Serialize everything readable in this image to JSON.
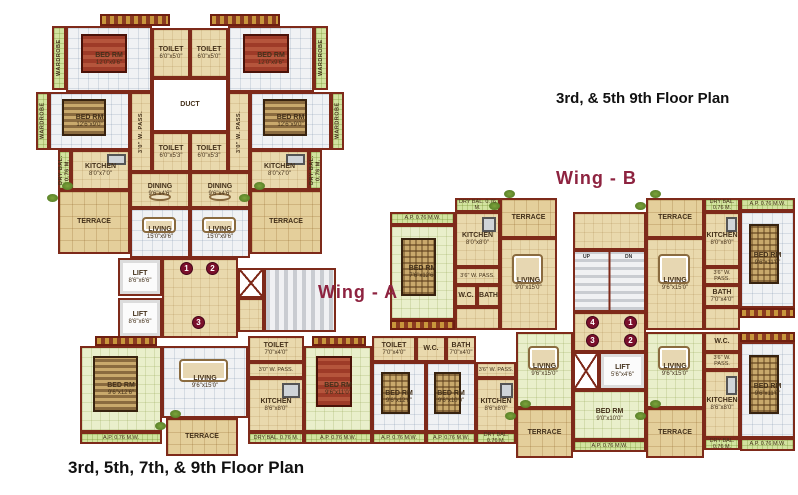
{
  "titles": {
    "plan_top": "3rd, & 5th 9th Floor Plan",
    "plan_bottom": "3rd, 5th, 7th, & 9th Floor Plan",
    "wing_a": "Wing - A",
    "wing_b": "Wing - B"
  },
  "colors": {
    "wall": "#7e2a1a",
    "floor_beige": "#e9d9ad",
    "floor_tile": "#f0f2f4",
    "floor_green": "#e9efcb",
    "terrace": "#e4cf9b",
    "balcony_strip": "#d2e39f",
    "stairs": "#c9ccd1",
    "marker": "#7a0f2b",
    "wing_label": "#8e2340",
    "title": "#111111"
  },
  "rooms": [
    {
      "id": "wardrobe-strip-1",
      "label": "WARDROBE",
      "x": 52,
      "y": 26,
      "w": 14,
      "h": 64,
      "fill": "strip",
      "dir": "v"
    },
    {
      "id": "bedroom-top-left",
      "label": "BED RM",
      "dims": "12'0\"x9'6\"",
      "x": 66,
      "y": 26,
      "w": 86,
      "h": 66,
      "fill": "white",
      "furn": "bed-red"
    },
    {
      "id": "toilet-top-1",
      "label": "TOILET",
      "dims": "6'0\"x5'0\"",
      "x": 152,
      "y": 28,
      "w": 38,
      "h": 50,
      "fill": "beige"
    },
    {
      "id": "toilet-top-2",
      "label": "TOILET",
      "dims": "6'0\"x5'0\"",
      "x": 190,
      "y": 28,
      "w": 38,
      "h": 50,
      "fill": "beige"
    },
    {
      "id": "bedroom-top-right",
      "label": "BED RM",
      "dims": "12'0\"x9'6\"",
      "x": 228,
      "y": 26,
      "w": 86,
      "h": 66,
      "fill": "white",
      "furn": "bed-red"
    },
    {
      "id": "wardrobe-strip-2",
      "label": "WARDROBE",
      "x": 314,
      "y": 26,
      "w": 14,
      "h": 64,
      "fill": "strip",
      "dir": "v"
    },
    {
      "id": "wardrobe-strip-3",
      "label": "WARDROBE",
      "x": 36,
      "y": 92,
      "w": 13,
      "h": 58,
      "fill": "strip",
      "dir": "v"
    },
    {
      "id": "bedroom-mid-left",
      "label": "BED RM",
      "dims": "12'6\"x9'0\"",
      "x": 49,
      "y": 92,
      "w": 81,
      "h": 58,
      "fill": "white",
      "furn": "bed-striped"
    },
    {
      "id": "duct",
      "label": "DUCT",
      "x": 152,
      "y": 78,
      "w": 76,
      "h": 54,
      "fill": "duct"
    },
    {
      "id": "bedroom-mid-right",
      "label": "BED RM",
      "dims": "12'6\"x9'0\"",
      "x": 250,
      "y": 92,
      "w": 81,
      "h": 58,
      "fill": "white",
      "furn": "bed-striped"
    },
    {
      "id": "wardrobe-strip-4",
      "label": "WARDROBE",
      "x": 331,
      "y": 92,
      "w": 13,
      "h": 58,
      "fill": "strip",
      "dir": "v"
    },
    {
      "id": "passage-left",
      "label": "3'0\" W. PASS.",
      "x": 130,
      "y": 92,
      "w": 22,
      "h": 80,
      "fill": "beige",
      "dir": "v"
    },
    {
      "id": "passage-right",
      "label": "3'0\" W. PASS.",
      "x": 228,
      "y": 92,
      "w": 22,
      "h": 80,
      "fill": "beige",
      "dir": "v"
    },
    {
      "id": "toilet-mid-1",
      "label": "TOILET",
      "dims": "6'0\"x5'3\"",
      "x": 152,
      "y": 132,
      "w": 38,
      "h": 40,
      "fill": "beige"
    },
    {
      "id": "toilet-mid-2",
      "label": "TOILET",
      "dims": "6'0\"x5'3\"",
      "x": 190,
      "y": 132,
      "w": 38,
      "h": 40,
      "fill": "beige"
    },
    {
      "id": "drybal-strip-1",
      "label": "DRY BAL. 0.76 M.",
      "x": 58,
      "y": 150,
      "w": 13,
      "h": 40,
      "fill": "strip",
      "dir": "v"
    },
    {
      "id": "kitchen-left",
      "label": "KITCHEN",
      "dims": "8'0\"x7'0\"",
      "x": 71,
      "y": 150,
      "w": 59,
      "h": 40,
      "fill": "beige",
      "furn": "kitchen"
    },
    {
      "id": "dining-left",
      "label": "DINING",
      "dims": "9'6\"x4'6\"",
      "x": 130,
      "y": 172,
      "w": 60,
      "h": 36,
      "fill": "beige",
      "furn": "table"
    },
    {
      "id": "dining-right",
      "label": "DINING",
      "dims": "9'6\"x4'6\"",
      "x": 190,
      "y": 172,
      "w": 60,
      "h": 36,
      "fill": "beige",
      "furn": "table"
    },
    {
      "id": "kitchen-right",
      "label": "KITCHEN",
      "dims": "8'0\"x7'0\"",
      "x": 250,
      "y": 150,
      "w": 59,
      "h": 40,
      "fill": "beige",
      "furn": "kitchen"
    },
    {
      "id": "drybal-strip-2",
      "label": "DRY BAL. 0.76 M.",
      "x": 309,
      "y": 150,
      "w": 13,
      "h": 40,
      "fill": "strip",
      "dir": "v"
    },
    {
      "id": "terrace-left",
      "label": "TERRACE",
      "x": 58,
      "y": 190,
      "w": 72,
      "h": 64,
      "fill": "terrace",
      "furn": "plants"
    },
    {
      "id": "living-left",
      "label": "LIVING",
      "dims": "15'0\"x9'6\"",
      "x": 130,
      "y": 208,
      "w": 60,
      "h": 50,
      "fill": "white",
      "furn": "sofa"
    },
    {
      "id": "living-right",
      "label": "LIVING",
      "dims": "15'0\"x9'6\"",
      "x": 190,
      "y": 208,
      "w": 60,
      "h": 50,
      "fill": "white",
      "furn": "sofa"
    },
    {
      "id": "terrace-right",
      "label": "TERRACE",
      "x": 250,
      "y": 190,
      "w": 72,
      "h": 64,
      "fill": "terrace",
      "furn": "plants"
    },
    {
      "id": "lift-1",
      "label": "LIFT",
      "dims": "8'6\"x6'6\"",
      "x": 118,
      "y": 258,
      "w": 44,
      "h": 38,
      "fill": "lift"
    },
    {
      "id": "lift-2",
      "label": "LIFT",
      "dims": "8'6\"x6'6\"",
      "x": 118,
      "y": 298,
      "w": 44,
      "h": 40,
      "fill": "lift"
    },
    {
      "id": "lobby-a",
      "x": 162,
      "y": 258,
      "w": 76,
      "h": 80,
      "fill": "beige"
    },
    {
      "id": "lift-shaft-a",
      "x": 238,
      "y": 268,
      "w": 26,
      "h": 30,
      "fill": "shaft"
    },
    {
      "id": "shaft-landing-a",
      "x": 238,
      "y": 298,
      "w": 26,
      "h": 34,
      "fill": "beige"
    },
    {
      "id": "stairs-a",
      "x": 264,
      "y": 268,
      "w": 72,
      "h": 64,
      "fill": "stairsh"
    },
    {
      "id": "wa-bedroom-1",
      "label": "BED RM",
      "dims": "9'6\"x12'6\"",
      "x": 80,
      "y": 346,
      "w": 82,
      "h": 86,
      "fill": "green",
      "furn": "bed-striped"
    },
    {
      "id": "wa-ap-strip-1",
      "label": "A.P. 0.76 M.W.",
      "x": 80,
      "y": 432,
      "w": 82,
      "h": 12,
      "fill": "strip"
    },
    {
      "id": "wa-living",
      "label": "LIVING",
      "dims": "9'6\"x15'0\"",
      "x": 162,
      "y": 346,
      "w": 86,
      "h": 72,
      "fill": "white",
      "furn": "sofa"
    },
    {
      "id": "wa-terrace",
      "label": "TERRACE",
      "x": 166,
      "y": 418,
      "w": 72,
      "h": 38,
      "fill": "terrace",
      "furn": "plants"
    },
    {
      "id": "wa-toilet",
      "label": "TOILET",
      "dims": "7'0\"x4'0\"",
      "x": 248,
      "y": 336,
      "w": 56,
      "h": 26,
      "fill": "beige"
    },
    {
      "id": "wa-passage",
      "label": "3'0\" W. PASS.",
      "x": 248,
      "y": 362,
      "w": 56,
      "h": 16,
      "fill": "beige",
      "striplab": true
    },
    {
      "id": "wa-kitchen",
      "label": "KITCHEN",
      "dims": "8'6\"x8'0\"",
      "x": 248,
      "y": 378,
      "w": 56,
      "h": 54,
      "fill": "beige",
      "furn": "kitchen"
    },
    {
      "id": "wa-drybal-strip",
      "label": "DRY BAL. 0.76 M.",
      "x": 248,
      "y": 432,
      "w": 56,
      "h": 12,
      "fill": "strip"
    },
    {
      "id": "wa-bedroom-2",
      "label": "BED RM",
      "dims": "9'6\"x11'0\"",
      "x": 304,
      "y": 346,
      "w": 68,
      "h": 86,
      "fill": "green",
      "furn": "bed-red"
    },
    {
      "id": "wa-ap-strip-2",
      "label": "A.P. 0.76 M.W.",
      "x": 304,
      "y": 432,
      "w": 68,
      "h": 12,
      "fill": "strip"
    },
    {
      "id": "wbbl-toilet",
      "label": "TOILET",
      "dims": "7'0\"x4'0\"",
      "x": 372,
      "y": 336,
      "w": 44,
      "h": 26,
      "fill": "beige"
    },
    {
      "id": "wbbl-bedroom-1",
      "label": "BED RM",
      "dims": "9'6\"x12'6\"",
      "x": 372,
      "y": 362,
      "w": 54,
      "h": 70,
      "fill": "white",
      "furn": "bed-plaid"
    },
    {
      "id": "wbbl-ap-strip-1",
      "label": "A.P. 0.76 M.W.",
      "x": 372,
      "y": 432,
      "w": 54,
      "h": 12,
      "fill": "strip"
    },
    {
      "id": "wbbl-wc",
      "label": "W.C.",
      "x": 416,
      "y": 336,
      "w": 30,
      "h": 26,
      "fill": "beige"
    },
    {
      "id": "wbbl-bath",
      "label": "BATH",
      "dims": "7'0\"x4'0\"",
      "x": 446,
      "y": 336,
      "w": 30,
      "h": 26,
      "fill": "beige"
    },
    {
      "id": "wbbl-bedroom-2",
      "label": "BED RM",
      "dims": "9'6\"x10'0\"",
      "x": 426,
      "y": 362,
      "w": 50,
      "h": 70,
      "fill": "white",
      "furn": "bed-plaid"
    },
    {
      "id": "wbbl-ap-strip-2",
      "label": "A.P. 0.76 M.W.",
      "x": 426,
      "y": 432,
      "w": 50,
      "h": 12,
      "fill": "strip"
    },
    {
      "id": "wbbl-passage",
      "label": "3'6\" W. PASS.",
      "x": 476,
      "y": 362,
      "w": 40,
      "h": 16,
      "fill": "beige",
      "striplab": true
    },
    {
      "id": "wbbl-kitchen",
      "label": "KITCHEN",
      "dims": "8'6\"x8'0\"",
      "x": 476,
      "y": 378,
      "w": 40,
      "h": 54,
      "fill": "beige",
      "furn": "kitchen"
    },
    {
      "id": "wbbl-drybal-strip",
      "label": "DRY BAL. 0.76 M.",
      "x": 476,
      "y": 432,
      "w": 40,
      "h": 12,
      "fill": "strip"
    },
    {
      "id": "wbbl-living",
      "label": "LIVING",
      "dims": "9'6\"x15'0\"",
      "x": 516,
      "y": 332,
      "w": 57,
      "h": 76,
      "fill": "green",
      "furn": "sofa"
    },
    {
      "id": "wbbl-terrace",
      "label": "TERRACE",
      "x": 516,
      "y": 408,
      "w": 57,
      "h": 50,
      "fill": "terrace",
      "furn": "plants"
    },
    {
      "id": "wbtl-ap-strip",
      "label": "A.P. 0.76 M.W.",
      "x": 390,
      "y": 212,
      "w": 65,
      "h": 13,
      "fill": "strip"
    },
    {
      "id": "wbtl-bedroom",
      "label": "BED RM",
      "dims": "7'6\"x12'6\"",
      "x": 390,
      "y": 225,
      "w": 65,
      "h": 95,
      "fill": "green",
      "furn": "bed-plaid"
    },
    {
      "id": "wbtl-drybal-strip",
      "label": "DRY BAL. 0.76 M.",
      "x": 455,
      "y": 198,
      "w": 45,
      "h": 14,
      "fill": "strip"
    },
    {
      "id": "wbtl-kitchen",
      "label": "KITCHEN",
      "dims": "8'0\"x8'0\"",
      "x": 455,
      "y": 212,
      "w": 45,
      "h": 55,
      "fill": "beige",
      "furn": "kitchen"
    },
    {
      "id": "wbtl-passage",
      "label": "3'6\" W. PASS.",
      "x": 455,
      "y": 267,
      "w": 45,
      "h": 18,
      "fill": "beige",
      "striplab": true
    },
    {
      "id": "wbtl-wc",
      "label": "W.C.",
      "x": 455,
      "y": 285,
      "w": 22,
      "h": 22,
      "fill": "beige"
    },
    {
      "id": "wbtl-bath",
      "label": "BATH",
      "x": 477,
      "y": 285,
      "w": 23,
      "h": 22,
      "fill": "beige"
    },
    {
      "id": "wbtl-hall",
      "x": 455,
      "y": 307,
      "w": 45,
      "h": 23,
      "fill": "beige"
    },
    {
      "id": "wbtl-terrace",
      "label": "TERRACE",
      "x": 500,
      "y": 198,
      "w": 57,
      "h": 40,
      "fill": "terrace",
      "furn": "plants"
    },
    {
      "id": "wbtl-living",
      "label": "LIVING",
      "dims": "9'0\"x15'0\"",
      "x": 500,
      "y": 238,
      "w": 57,
      "h": 92,
      "fill": "beige",
      "furn": "sofa"
    },
    {
      "id": "wbc-landing",
      "x": 573,
      "y": 212,
      "w": 73,
      "h": 38,
      "fill": "beige"
    },
    {
      "id": "wbc-stairs",
      "x": 573,
      "y": 250,
      "w": 73,
      "h": 62,
      "fill": "stairsv"
    },
    {
      "id": "wbc-lobby",
      "x": 573,
      "y": 312,
      "w": 73,
      "h": 40,
      "fill": "beige"
    },
    {
      "id": "wbc-lift-shaft",
      "x": 573,
      "y": 352,
      "w": 26,
      "h": 38,
      "fill": "shaft"
    },
    {
      "id": "wbc-lift",
      "label": "LIFT",
      "dims": "5'6\"x4'6\"",
      "x": 599,
      "y": 352,
      "w": 47,
      "h": 38,
      "fill": "lift"
    },
    {
      "id": "wbc-bedroom",
      "label": "BED RM",
      "dims": "9'0\"x10'0\"",
      "x": 573,
      "y": 390,
      "w": 73,
      "h": 50,
      "fill": "green"
    },
    {
      "id": "wbc-ap-strip",
      "label": "A.P. 0.76 M.W.",
      "x": 573,
      "y": 440,
      "w": 73,
      "h": 12,
      "fill": "strip"
    },
    {
      "id": "wbtr-terrace",
      "label": "TERRACE",
      "x": 646,
      "y": 198,
      "w": 58,
      "h": 40,
      "fill": "terrace",
      "furn": "plants"
    },
    {
      "id": "wbtr-living",
      "label": "LIVING",
      "dims": "9'6\"x15'0\"",
      "x": 646,
      "y": 238,
      "w": 58,
      "h": 92,
      "fill": "beige",
      "furn": "sofa"
    },
    {
      "id": "wbtr-drybal-strip",
      "label": "DRY BAL. 0.76 M.",
      "x": 704,
      "y": 198,
      "w": 36,
      "h": 14,
      "fill": "strip"
    },
    {
      "id": "wbtr-kitchen",
      "label": "KITCHEN",
      "dims": "8'0\"x8'0\"",
      "x": 704,
      "y": 212,
      "w": 36,
      "h": 55,
      "fill": "beige",
      "furn": "kitchen"
    },
    {
      "id": "wbtr-passage",
      "label": "3'6\" W. PASS.",
      "x": 704,
      "y": 267,
      "w": 36,
      "h": 18,
      "fill": "beige",
      "striplab": true
    },
    {
      "id": "wbtr-bath",
      "label": "BATH",
      "dims": "7'0\"x4'0\"",
      "x": 704,
      "y": 285,
      "w": 36,
      "h": 22,
      "fill": "beige"
    },
    {
      "id": "wbtr-hall",
      "x": 704,
      "y": 307,
      "w": 36,
      "h": 23,
      "fill": "beige"
    },
    {
      "id": "wbtr-ap-strip",
      "label": "A.P. 0.76 M.W.",
      "x": 740,
      "y": 198,
      "w": 55,
      "h": 13,
      "fill": "strip"
    },
    {
      "id": "wbtr-bedroom",
      "label": "BED RM",
      "dims": "9'6\"x11'0\"",
      "x": 740,
      "y": 211,
      "w": 55,
      "h": 97,
      "fill": "white",
      "furn": "bed-plaid"
    },
    {
      "id": "wbbr-living",
      "label": "LIVING",
      "dims": "9'6\"x15'0\"",
      "x": 646,
      "y": 332,
      "w": 58,
      "h": 76,
      "fill": "green",
      "furn": "sofa"
    },
    {
      "id": "wbbr-terrace",
      "label": "TERRACE",
      "x": 646,
      "y": 408,
      "w": 58,
      "h": 50,
      "fill": "terrace",
      "furn": "plants"
    },
    {
      "id": "wbbr-wc",
      "label": "W.C.",
      "x": 704,
      "y": 332,
      "w": 36,
      "h": 20,
      "fill": "beige"
    },
    {
      "id": "wbbr-passage",
      "label": "3'6\" W. PASS.",
      "x": 704,
      "y": 352,
      "w": 36,
      "h": 18,
      "fill": "beige",
      "striplab": true
    },
    {
      "id": "wbbr-kitchen",
      "label": "KITCHEN",
      "dims": "8'6\"x8'0\"",
      "x": 704,
      "y": 370,
      "w": 36,
      "h": 68,
      "fill": "beige",
      "furn": "kitchen"
    },
    {
      "id": "wbbr-drybal-strip",
      "label": "DRY BAL. 0.76 M.",
      "x": 704,
      "y": 438,
      "w": 36,
      "h": 12,
      "fill": "strip"
    },
    {
      "id": "wbbr-bedroom",
      "label": "BED RM",
      "dims": "9'6\"x11'0\"",
      "x": 740,
      "y": 342,
      "w": 55,
      "h": 96,
      "fill": "white",
      "furn": "bed-plaid"
    },
    {
      "id": "wbbr-ap-strip",
      "label": "A.P. 0.76 M.W.",
      "x": 740,
      "y": 438,
      "w": 55,
      "h": 13,
      "fill": "strip"
    }
  ],
  "boards": [
    {
      "id": "name-board-1",
      "x": 100,
      "y": 14,
      "w": 70,
      "h": 12
    },
    {
      "id": "name-board-2",
      "x": 210,
      "y": 14,
      "w": 70,
      "h": 12
    },
    {
      "id": "name-board-3",
      "x": 95,
      "y": 336,
      "w": 62,
      "h": 10
    },
    {
      "id": "name-board-4",
      "x": 312,
      "y": 336,
      "w": 54,
      "h": 10
    },
    {
      "id": "name-board-5",
      "x": 390,
      "y": 320,
      "w": 65,
      "h": 10
    },
    {
      "id": "name-board-6",
      "x": 740,
      "y": 308,
      "w": 55,
      "h": 10
    },
    {
      "id": "name-board-7",
      "x": 740,
      "y": 332,
      "w": 55,
      "h": 10
    }
  ],
  "markers": [
    {
      "n": "1",
      "x": 180,
      "y": 262
    },
    {
      "n": "2",
      "x": 206,
      "y": 262
    },
    {
      "n": "3",
      "x": 192,
      "y": 316
    },
    {
      "n": "4",
      "x": 586,
      "y": 316
    },
    {
      "n": "1",
      "x": 624,
      "y": 316
    },
    {
      "n": "3",
      "x": 586,
      "y": 334
    },
    {
      "n": "2",
      "x": 624,
      "y": 334
    }
  ],
  "stair_labels": [
    {
      "t": "UP",
      "x": 583,
      "y": 254
    },
    {
      "t": "DN",
      "x": 625,
      "y": 254
    }
  ]
}
